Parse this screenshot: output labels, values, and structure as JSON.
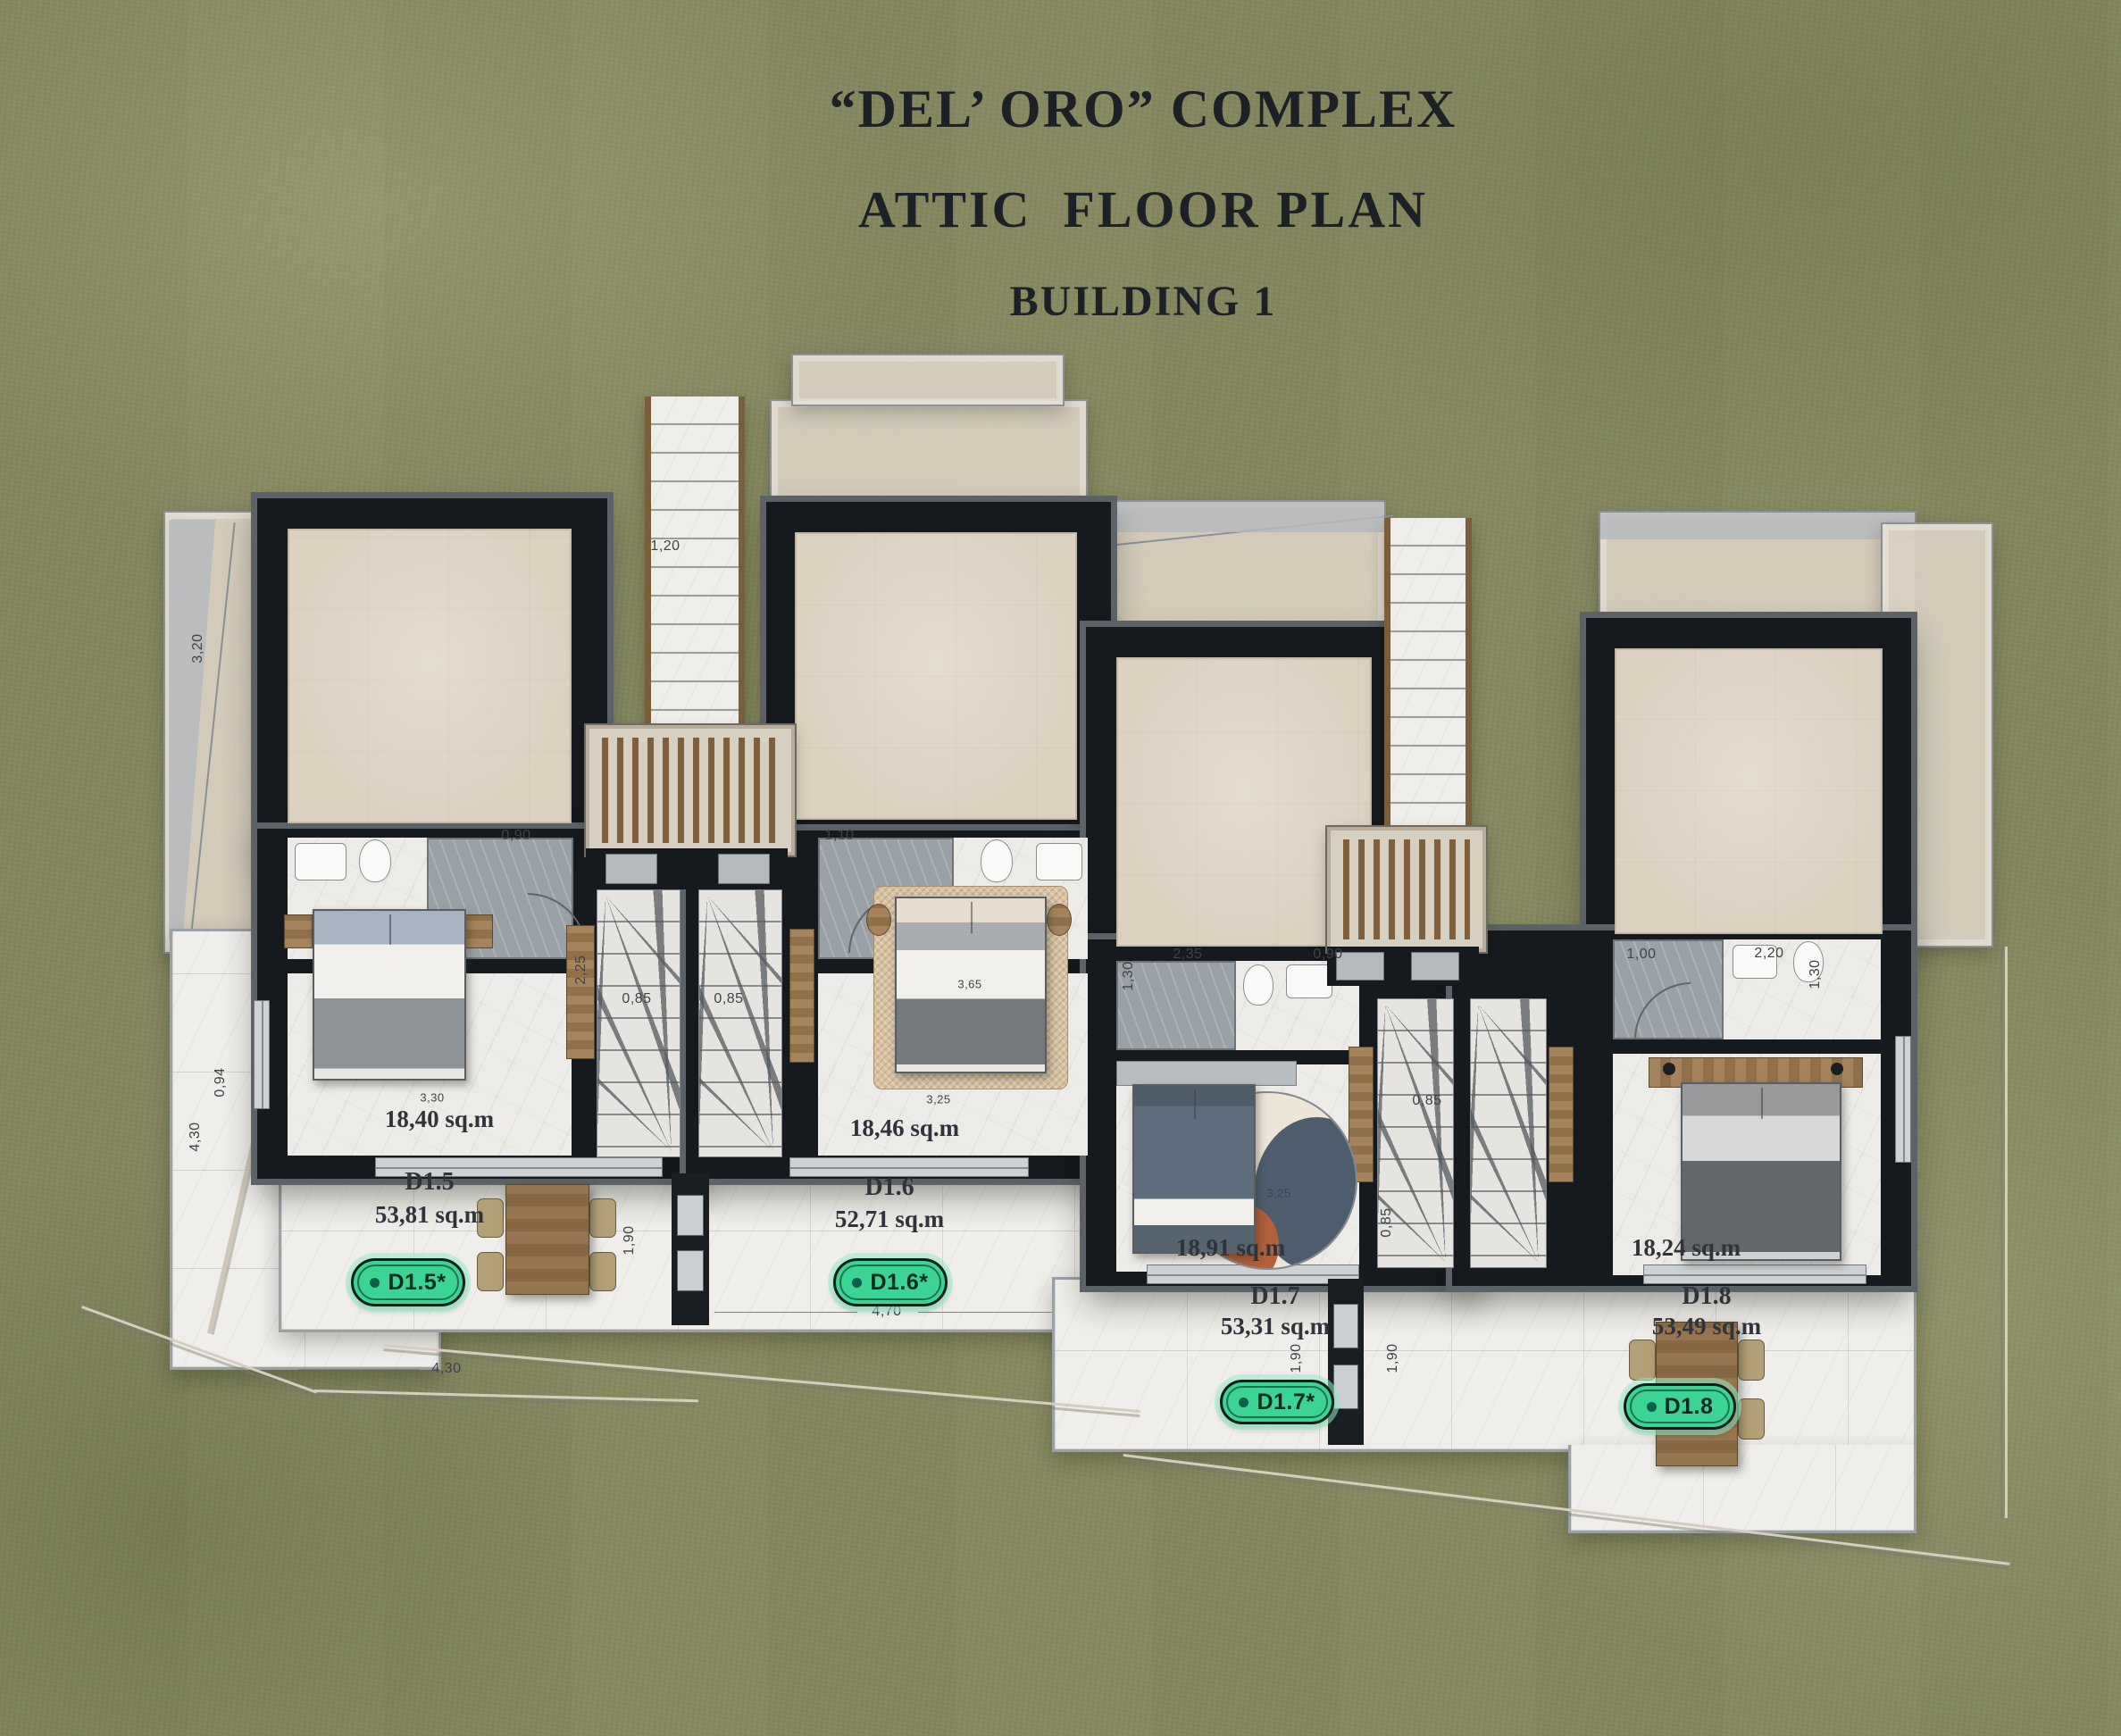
{
  "title": {
    "line1": "“DEL’ ORO” COMPLEX",
    "line2": "ATTIC  FLOOR PLAN",
    "line3": "BUILDING 1"
  },
  "units": [
    {
      "id": "D1.5",
      "total_area": "53,81 sq.m",
      "room_area": "18,40 sq.m",
      "badge": "D1.5*"
    },
    {
      "id": "D1.6",
      "total_area": "52,71 sq.m",
      "room_area": "18,46 sq.m",
      "badge": "D1.6*"
    },
    {
      "id": "D1.7",
      "total_area": "53,31 sq.m",
      "room_area": "18,91 sq.m",
      "badge": "D1.7*"
    },
    {
      "id": "D1.8",
      "total_area": "53,49 sq.m",
      "room_area": "18,24 sq.m",
      "badge": "D1.8"
    }
  ],
  "dims": [
    {
      "t": "1,20"
    },
    {
      "t": "0,90"
    },
    {
      "t": "1,10"
    },
    {
      "t": "2,25"
    },
    {
      "t": "0,85"
    },
    {
      "t": "0,85"
    },
    {
      "t": "3,30"
    },
    {
      "t": "3,25"
    },
    {
      "t": "2,35"
    },
    {
      "t": "0,90"
    },
    {
      "t": "1,30"
    },
    {
      "t": "0,85"
    },
    {
      "t": "0,85"
    },
    {
      "t": "1,00"
    },
    {
      "t": "2,20"
    },
    {
      "t": "1,30"
    },
    {
      "t": "4,30"
    },
    {
      "t": "1,90"
    },
    {
      "t": "4,70"
    },
    {
      "t": "1,90"
    },
    {
      "t": "1,90"
    },
    {
      "t": "3,20"
    },
    {
      "t": "4,30"
    },
    {
      "t": "0,94"
    },
    {
      "t": "3,65"
    },
    {
      "t": "3,25"
    }
  ],
  "colors": {
    "badge_green": "#3cd494",
    "badge_text": "#07291f",
    "wall": "#16191d",
    "wall_outline": "#5c6268",
    "grass": "#878a60",
    "beige": "#dcd1c1",
    "marble": "#edebe7",
    "roof": "#d9cfc2",
    "title_text": "#1d2125",
    "dim_text": "#3f4347"
  }
}
